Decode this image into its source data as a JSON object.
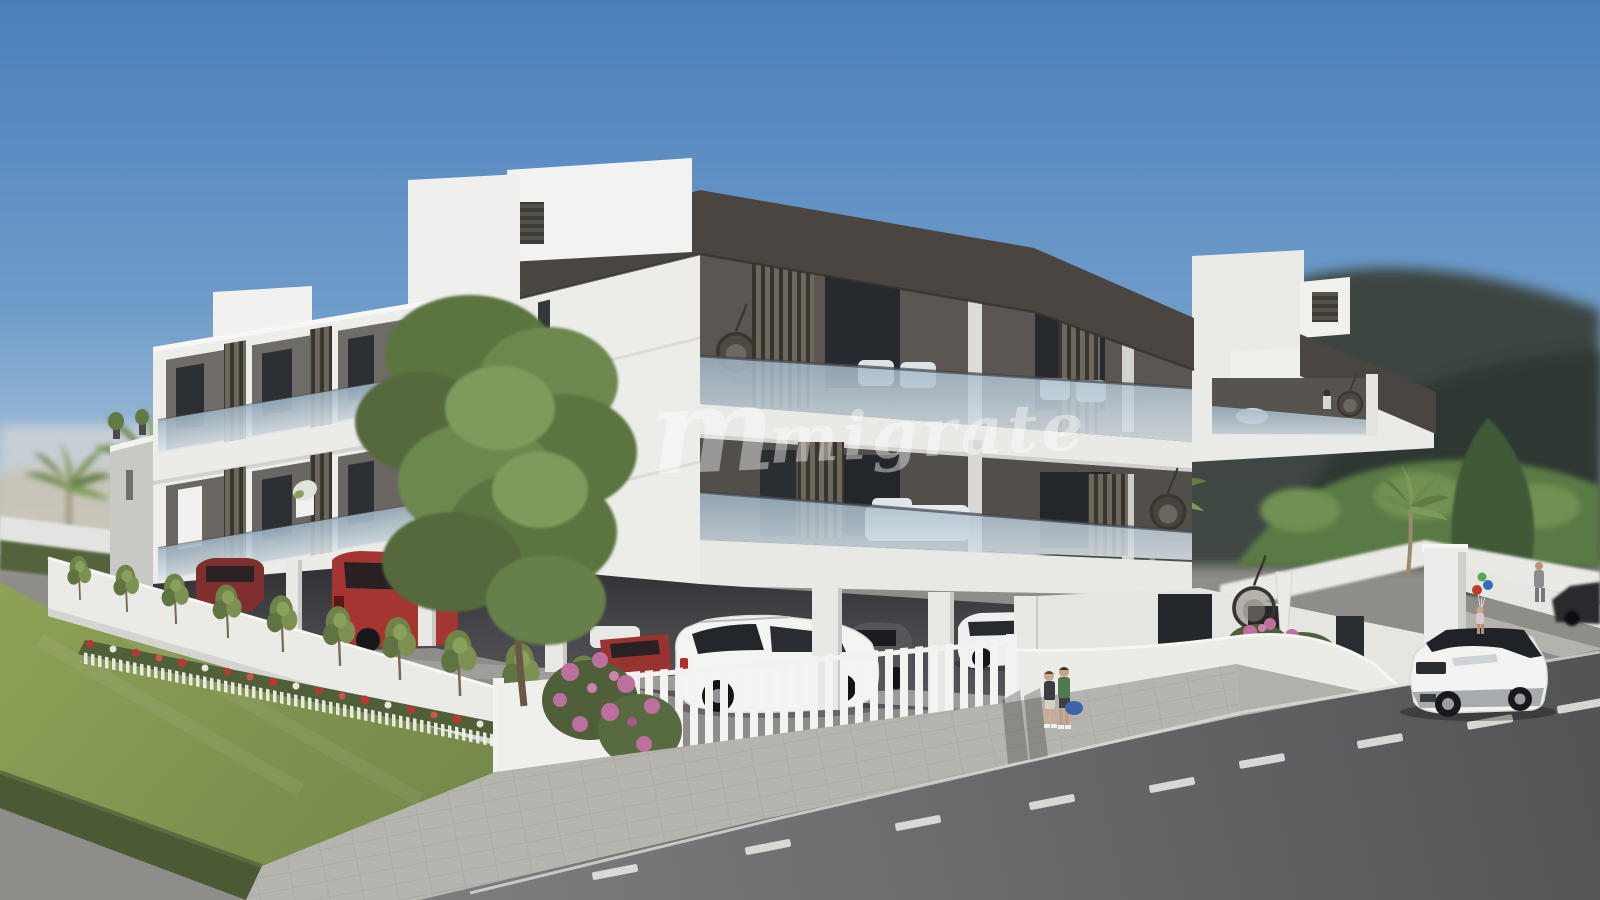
{
  "image": {
    "kind": "3d-architectural-render",
    "subject": "Modern white flat-roof apartment complex with dark fascia bands, glass balconies, louver screens, covered ground-floor parking, landscaped garden and street scene on a sunny day",
    "width_px": 1600,
    "height_px": 900
  },
  "watermark": {
    "logo_glyph": "m",
    "text": "migrate",
    "color": "#ffffff",
    "opacity": "0.42"
  },
  "palette": {
    "sky_top": "#4a7fbc",
    "sky_mid": "#6f9cc9",
    "sky_horizon": "#c3d4e2",
    "wall_white": "#ededea",
    "wall_shade": "#c8c8c5",
    "fascia_dark": "#4b4541",
    "glass_top": "#9db3c4",
    "glass_bottom": "#dde5ea",
    "louver_light": "#6e675c",
    "louver_dark": "#38342f",
    "lawn_light": "#8ea258",
    "lawn_dark": "#75894a",
    "hedge_green": "#4b5a35",
    "tree_green": "#6d8850",
    "road_top": "#535356",
    "road_bottom": "#7b7b7e",
    "sidewalk_gray": "#b6b4af",
    "flower_red": "#b23a30",
    "bougainvillea_pink": "#bd6f9d"
  },
  "scene": {
    "building": {
      "storeys": 3,
      "style": "contemporary stepped blocks",
      "features": [
        "dark charcoal roof fascia",
        "glass balustrade balconies",
        "vertical louver screens",
        "hanging egg chairs",
        "rooftop planters",
        "open parking at ground level"
      ]
    },
    "vehicles": [
      {
        "name": "white-suv-street",
        "color": "#f3f3f2",
        "location": "street, parked at kerb"
      },
      {
        "name": "dark-car-street",
        "color": "#2a2c2f",
        "location": "street, background"
      },
      {
        "name": "white-porsche-suv",
        "color": "#f4f4f2",
        "location": "covered parking"
      },
      {
        "name": "gray-coupe",
        "color": "#55565a",
        "location": "covered parking"
      },
      {
        "name": "white-sedan",
        "color": "#edeff0",
        "location": "covered parking"
      },
      {
        "name": "red-hatchback",
        "color": "#a43530",
        "location": "covered parking"
      },
      {
        "name": "maroon-sedan",
        "color": "#7e2f2e",
        "location": "covered parking"
      },
      {
        "name": "red-sedan",
        "color": "#993330",
        "location": "covered parking"
      }
    ],
    "people": [
      {
        "name": "couple-walking",
        "detail": "two pedestrians with a blue bag on the sidewalk"
      },
      {
        "name": "child-with-balloons",
        "detail": "child holding red, blue and green balloons"
      },
      {
        "name": "man-in-suit",
        "detail": "man walking on far sidewalk"
      },
      {
        "name": "resident-on-balcony",
        "detail": "person standing at balcony railing"
      }
    ],
    "landscaping": [
      "lawn",
      "boxwood hedge",
      "red and white flower bed with mini picket edging",
      "row of young trees along white retaining wall",
      "large deciduous tree",
      "bougainvillea shrubs",
      "palm trees",
      "dark conifer"
    ],
    "street": [
      "paved sidewalk",
      "asphalt road with dashed white lane markings",
      "white picket fence",
      "curved white boundary wall",
      "white gate pillar"
    ]
  }
}
